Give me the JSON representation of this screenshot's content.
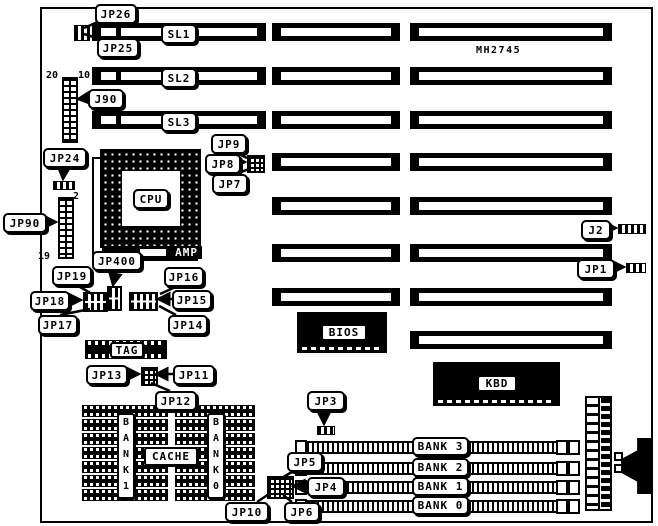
{
  "board": {
    "part_number": "MH2745"
  },
  "slot_labels": {
    "sl1": "SL1",
    "sl2": "SL2",
    "sl3": "SL3"
  },
  "chip_labels": {
    "cpu": "CPU",
    "amp": "AMP",
    "bios": "BIOS",
    "kbd": "KBD",
    "tag": "TAG",
    "cache": "CACHE"
  },
  "jumpers": {
    "jp26": "JP26",
    "jp25": "JP25",
    "j90": "J90",
    "jp24": "JP24",
    "jp90": "JP90",
    "jp400": "JP400",
    "jp19": "JP19",
    "jp18": "JP18",
    "jp17": "JP17",
    "jp16": "JP16",
    "jp15": "JP15",
    "jp14": "JP14",
    "jp9": "JP9",
    "jp8": "JP8",
    "jp7": "JP7",
    "j2": "J2",
    "jp1": "JP1",
    "jp13": "JP13",
    "jp11": "JP11",
    "jp12": "JP12",
    "jp3": "JP3",
    "jp5": "JP5",
    "jp4": "JP4",
    "jp6": "JP6",
    "jp10": "JP10"
  },
  "pin_numbers": {
    "j90_pin20": "20",
    "j90_pin10": "10",
    "jp90_pin2": "2",
    "jp90_pin19": "19"
  },
  "memory_banks": [
    "BANK 3",
    "BANK 2",
    "BANK 1",
    "BANK 0"
  ],
  "cache_bank_labels": {
    "bank1": "B\nA\nN\nK\n1",
    "bank0": "B\nA\nN\nK\n0"
  },
  "colors": {
    "foreground": "#000000",
    "background": "#ffffff"
  }
}
